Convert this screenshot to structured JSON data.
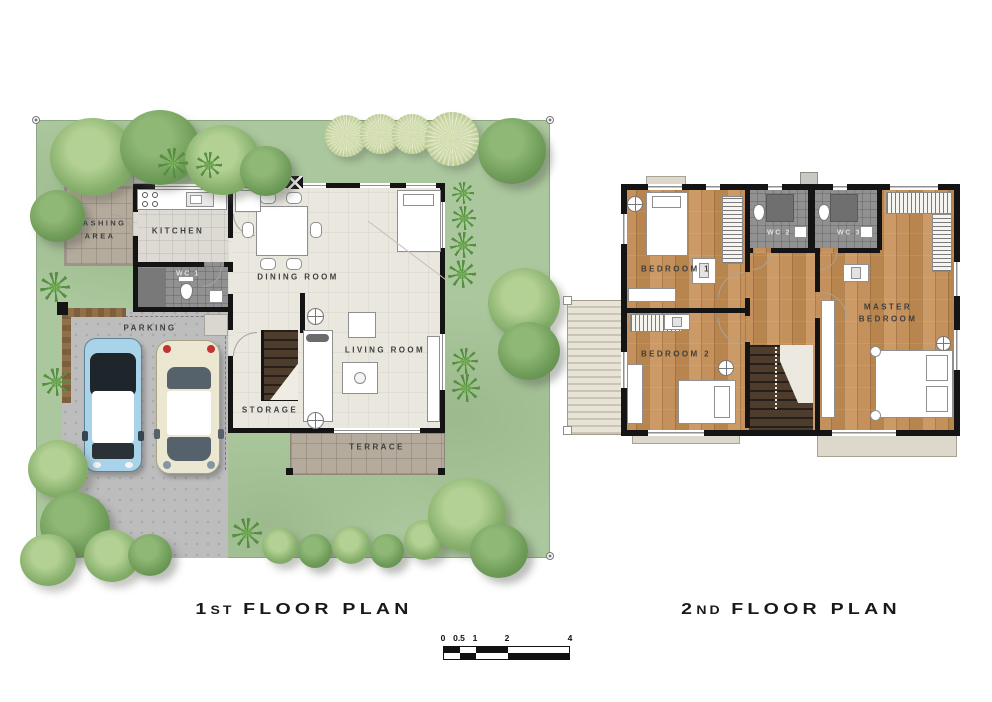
{
  "palette": {
    "grass": "#abc79d",
    "wood_floor": "#c4915c",
    "interior_floor": "#eae7df",
    "tile_floor": "#b5ab9c",
    "wc_floor": "#919191",
    "wall": "#141414",
    "stairs": "#4e3d2d",
    "parking": "#bdbdbd",
    "car_blue": "#a9d3e8",
    "car_cream": "#ece7d0",
    "roof": "#e7e3d6"
  },
  "plan1": {
    "title": {
      "num": "1",
      "ord": "ST",
      "rest": "FLOOR PLAN"
    },
    "rooms": {
      "washing1": "WASHING",
      "washing2": "AREA",
      "kitchen": "KITCHEN",
      "wc1": "WC 1",
      "parking": "PARKING",
      "dining": "DINING ROOM",
      "living": "LIVING ROOM",
      "storage": "STORAGE",
      "terrace": "TERRACE"
    }
  },
  "plan2": {
    "title": {
      "num": "2",
      "ord": "ND",
      "rest": "FLOOR PLAN"
    },
    "rooms": {
      "bedroom1": "BEDROOM 1",
      "bedroom2": "BEDROOM 2",
      "master1": "MASTER",
      "master2": "BEDROOM",
      "wc2": "WC 2",
      "wc3": "WC 3"
    }
  },
  "scalebar": {
    "labels": [
      "0",
      "0.5",
      "1",
      "2",
      "4"
    ]
  }
}
